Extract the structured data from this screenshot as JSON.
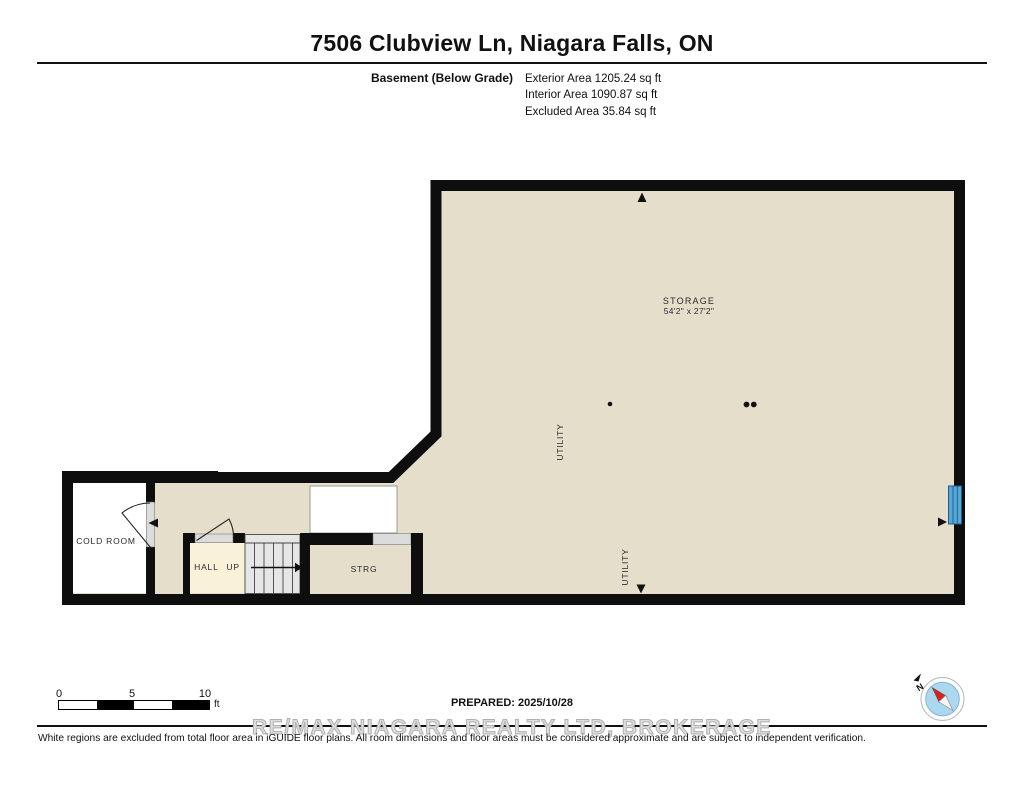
{
  "header": {
    "title": "7506 Clubview Ln, Niagara Falls, ON",
    "floor_label": "Basement (Below Grade)",
    "areas": [
      "Exterior Area 1205.24 sq ft",
      "Interior Area 1090.87 sq ft",
      "Excluded Area 35.84 sq ft"
    ]
  },
  "plan": {
    "labels": {
      "storage_name": "STORAGE",
      "storage_dims": "54'2\" x 27'2\"",
      "cold_room": "COLD ROOM",
      "hall": "HALL UP",
      "strg": "STRG",
      "utility_upper": "UTILITY",
      "utility_lower": "UTILITY"
    },
    "colors": {
      "floor": "#e5decb",
      "wall": "#0e0e0e",
      "hall_fill": "#f9f2d8",
      "stairs_fill": "#e6e6e6",
      "door_fill": "#dcdcdc",
      "window_blue": "#57a8d6",
      "excluded_white": "#ffffff"
    }
  },
  "scale_bar": {
    "ticks": [
      "0",
      "5",
      "10"
    ],
    "unit": "ft"
  },
  "compass": {
    "north_label": "N"
  },
  "footer": {
    "prepared": "PREPARED: 2025/10/28",
    "watermark": "RE/MAX NIAGARA REALTY LTD, BROKERAGE",
    "disclaimer": "White regions are excluded from total floor area in iGUIDE floor plans. All room dimensions and floor areas must be considered approximate and are subject to independent verification."
  }
}
